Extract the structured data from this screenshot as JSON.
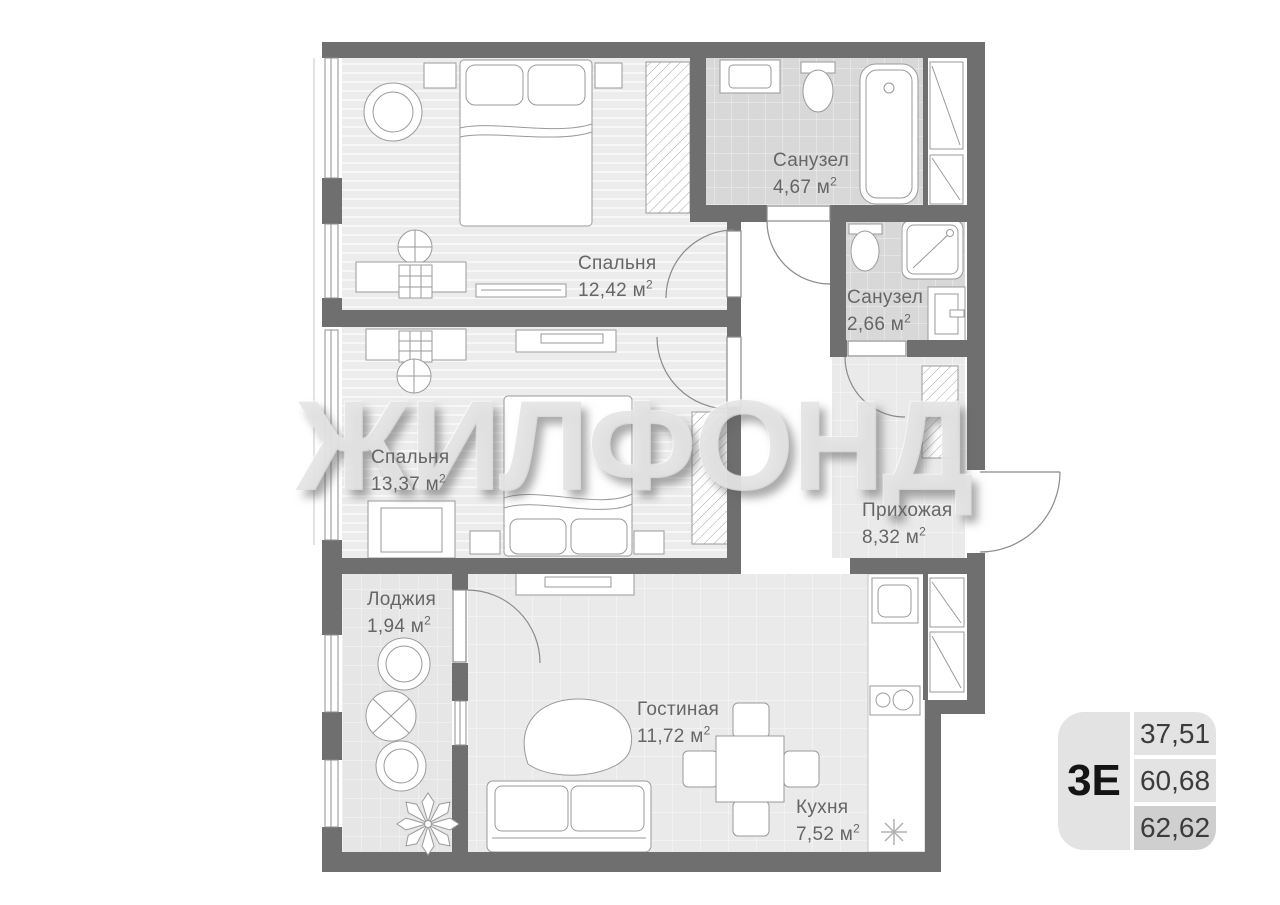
{
  "watermark": "ЖИЛФОНД",
  "units": {
    "base": "м",
    "exp": "2"
  },
  "rooms": [
    {
      "name": "Спальня",
      "area": "12,42"
    },
    {
      "name": "Санузел",
      "area": "4,67"
    },
    {
      "name": "Санузел",
      "area": "2,66"
    },
    {
      "name": "Спальня",
      "area": "13,37"
    },
    {
      "name": "Прихожая",
      "area": "8,32"
    },
    {
      "name": "Лоджия",
      "area": "1,94"
    },
    {
      "name": "Гостиная",
      "area": "11,72"
    },
    {
      "name": "Кухня",
      "area": "7,52"
    }
  ],
  "info_box": {
    "unit_type": "3Е",
    "values": [
      "37,51",
      "60,68",
      "62,62"
    ]
  },
  "colors": {
    "wall": "#6f6f6f",
    "bedroom_floor": "#ececec",
    "tile_floor": "#d8d8d8",
    "hall_floor": "#eaeaea",
    "loggia_floor": "#e6e6e6",
    "label_text": "#666666",
    "infobox_bg": "#e3e3e3",
    "infobox_dark_bg": "#cfcfcf",
    "infobox_type_text": "#141414",
    "infobox_value_text": "#3c3c3c"
  }
}
